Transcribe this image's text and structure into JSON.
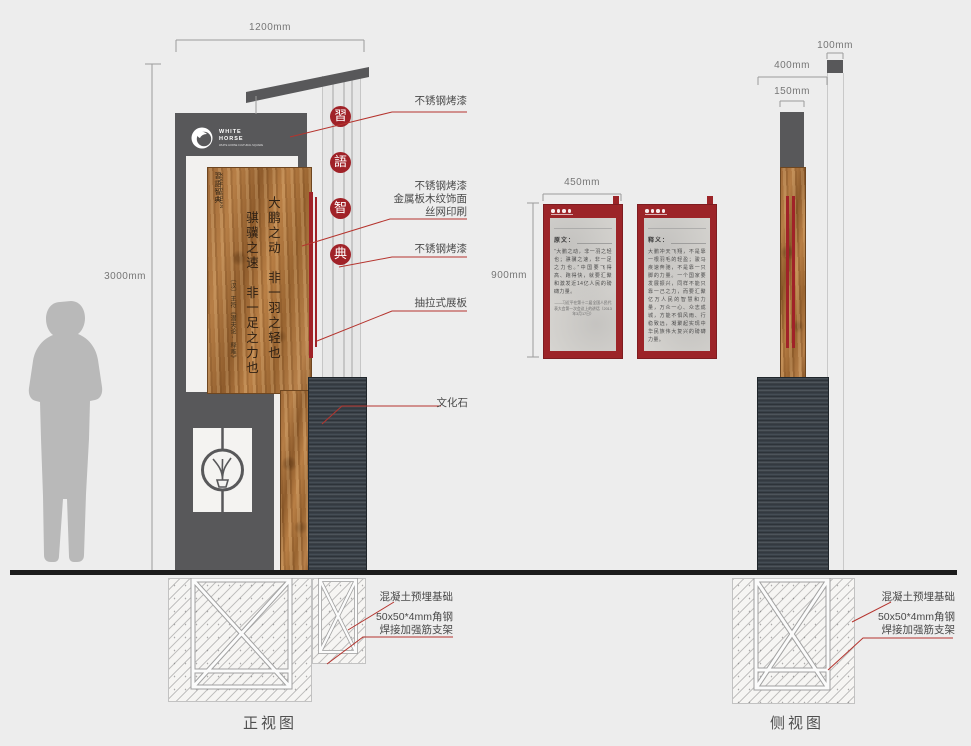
{
  "front": {
    "caption": "正视图",
    "dims": {
      "width": "1200mm",
      "height": "3000mm"
    },
    "logo": {
      "line1": "WHITE",
      "line2": "HORSE",
      "sub": "WHITE HORSE CULTURAL SQUARE"
    },
    "medallions": [
      "習",
      "語",
      "智",
      "典"
    ],
    "wood": {
      "header": "習語智典",
      "header_latin": "XIYU ZHIDIAN",
      "col1": "大鹏之动　非一羽之轻也",
      "col2": "骐骥之速　非一足之力也",
      "cite": "〔汉〕王符《潜夫论·释难》"
    },
    "annotations": {
      "steel_top": "不锈钢烤漆",
      "wood_lines": [
        "不锈钢烤漆",
        "金属板木纹饰面",
        "丝网印刷"
      ],
      "steel_mid": "不锈钢烤漆",
      "drawer": "抽拉式展板",
      "stone": "文化石",
      "foundation": "混凝土预埋基础",
      "bracket_lines": [
        "50x50*4mm角钢",
        "焊接加强筋支架"
      ]
    }
  },
  "panels": {
    "dim_width": "450mm",
    "dim_height": "900mm",
    "a": {
      "title": "原文：",
      "body": "“大鹏之动，非一羽之轻也；骐骥之速，非一足之力也。”中国要飞得高、跑得快，就要汇聚和激发近14亿人民的磅礴力量。",
      "source": "——习近平在第十二届全国人民代表大会第一次会议上的讲话（2013年3月17日）"
    },
    "b": {
      "title": "释义：",
      "body": "大鹏冲天飞翔，不是靠一根羽毛的轻盈；骏马疾速奔驰，不是靠一只脚的力量。一个国家要发展振兴，同样不能只靠一己之力，而要汇聚亿万人民的智慧和力量，万众一心、众志成城，方能不惧风雨、行稳致远，凝聚起实现中华民族伟大复兴的磅礴力量。"
    }
  },
  "side": {
    "caption": "侧视图",
    "dims": {
      "d100": "100mm",
      "d400": "400mm",
      "d150": "150mm"
    },
    "annotations": {
      "foundation": "混凝土预埋基础",
      "bracket_lines": [
        "50x50*4mm角钢",
        "焊接加强筋支架"
      ]
    }
  },
  "colors": {
    "accent_red": "#a02228",
    "panel_gray": "#58585a"
  }
}
